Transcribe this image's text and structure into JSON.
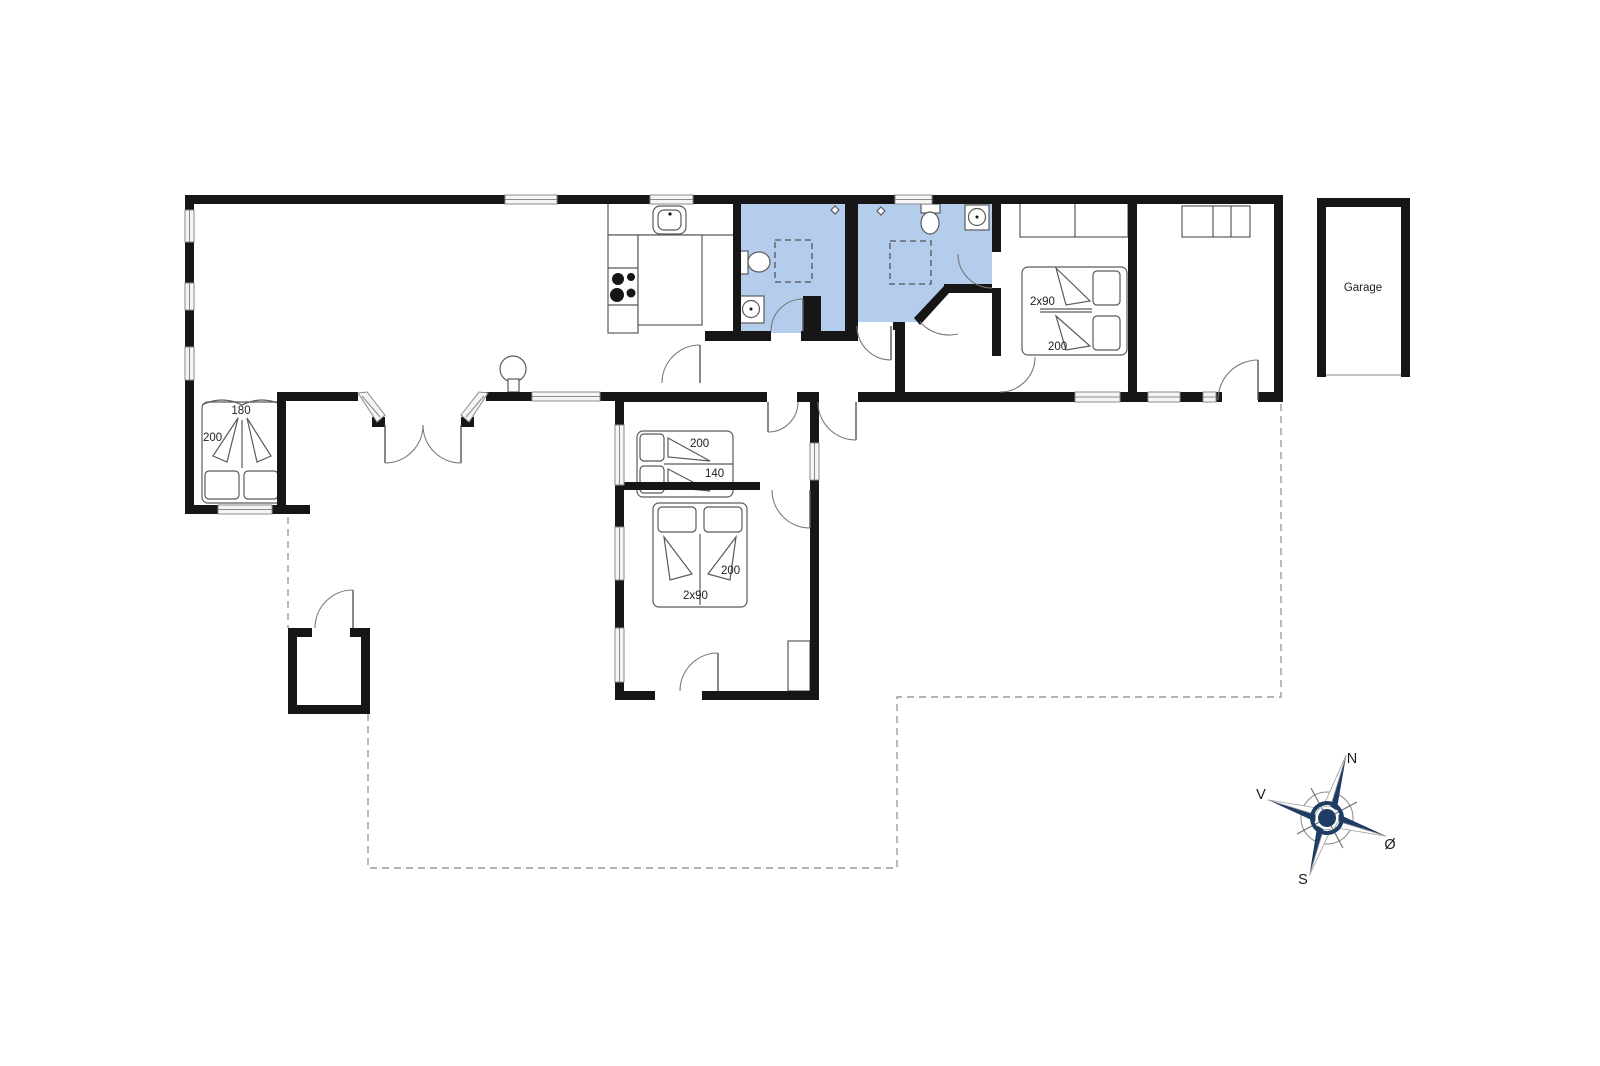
{
  "colors": {
    "wall": "#161616",
    "bath": "#b4cdec",
    "window_border": "#8a8a8a",
    "line": "#5a5a5a",
    "dash": "#9a9a9a",
    "compass_navy": "#1e3c64",
    "label": "#222222"
  },
  "beds": {
    "alcove": {
      "width_label": "180",
      "length_label": "200"
    },
    "middle": {
      "length_label": "200",
      "width_label": "140"
    },
    "south": {
      "length_label": "200",
      "type_label": "2x90"
    },
    "east": {
      "type_label": "2x90",
      "length_label": "200"
    }
  },
  "garage": {
    "label": "Garage"
  },
  "compass": {
    "n": "N",
    "v": "V",
    "s": "S",
    "o": "Ø"
  }
}
